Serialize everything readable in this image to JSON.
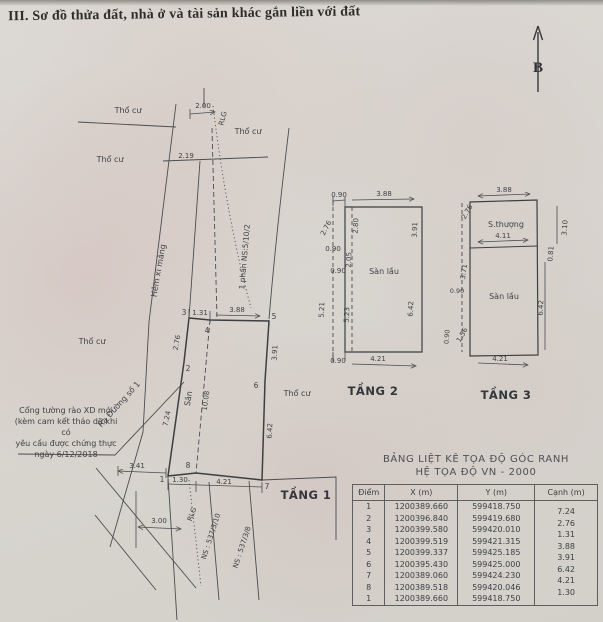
{
  "title": "III. Sơ đồ thửa đất, nhà ở và tài sản khác gắn liền với đất",
  "compass": {
    "north_label": "B"
  },
  "site": {
    "labels": {
      "tho_cu": "Thổ cư",
      "hem": "Hẻm xi măng",
      "phan_ns": "1 phần NS:5/10/2",
      "ra_duong": "Ra Đường số 1",
      "san": "Sân",
      "rlg": "RLG",
      "ns_a": "NS : 537/3/10",
      "ns_b": "NS : 537/3/8",
      "floor": "TẦNG 1"
    },
    "note": {
      "line1": "Cổng tường rào XD mới",
      "line2": "(kèm cam kết tháo dỡ khi có",
      "line3": "yêu cầu được chứng thực",
      "line4": "ngày  6/12/2018"
    },
    "points": {
      "p1": "1",
      "p2": "2",
      "p3": "3",
      "p4": "4",
      "p5": "5",
      "p6": "6",
      "p7": "7",
      "p8": "8"
    },
    "dims": {
      "d200": "2.00",
      "d219": "2.19",
      "d131": "1.31",
      "d388": "3.88",
      "d276": "2.76",
      "d391": "3.91",
      "d642": "6.42",
      "d724": "7.24",
      "d1008": "10.08",
      "d130": "1.30",
      "d421": "4.21",
      "d341": "3.41",
      "d300": "3.00"
    }
  },
  "tang2": {
    "floor": "TẦNG 2",
    "room": "Sàn lầu",
    "dims": {
      "d090": "0.90",
      "d388": "3.88",
      "d276": "2.76",
      "d521": "5.21",
      "d280": "2.80",
      "d205": "2.05",
      "d523": "5.23",
      "d391": "3.91",
      "d642": "6.42",
      "d421": "4.21"
    }
  },
  "tang3": {
    "floor": "TẦNG 3",
    "terrace": "S.thượng",
    "room": "Sàn lầu",
    "dims": {
      "d388": "3.88",
      "d276": "2.76",
      "d411": "4.11",
      "d310": "3.10",
      "d081": "0.81",
      "d642": "6.42",
      "d371": "3.71",
      "d090": "0.90",
      "d156": "1.56",
      "d421": "4.21"
    }
  },
  "table": {
    "title_line1": "BẢNG LIỆT KÊ TỌA ĐỘ GÓC RANH",
    "title_line2": "HỆ TỌA ĐỘ VN - 2000",
    "headers": [
      "Điểm",
      "X (m)",
      "Y (m)",
      "Cạnh (m)"
    ],
    "rows": [
      [
        "1",
        "1200389.660",
        "599418.750",
        "7.24"
      ],
      [
        "2",
        "1200396.840",
        "599419.680",
        "2.76"
      ],
      [
        "3",
        "1200399.580",
        "599420.010",
        "1.31"
      ],
      [
        "4",
        "1200399.519",
        "599421.315",
        "3.88"
      ],
      [
        "5",
        "1200399.337",
        "599425.185",
        "3.91"
      ],
      [
        "6",
        "1200395.430",
        "599425.000",
        "6.42"
      ],
      [
        "7",
        "1200389.060",
        "599424.230",
        "4.21"
      ],
      [
        "8",
        "1200389.518",
        "599420.046",
        "1.30"
      ],
      [
        "1",
        "1200389.660",
        "599418.750",
        ""
      ]
    ]
  }
}
